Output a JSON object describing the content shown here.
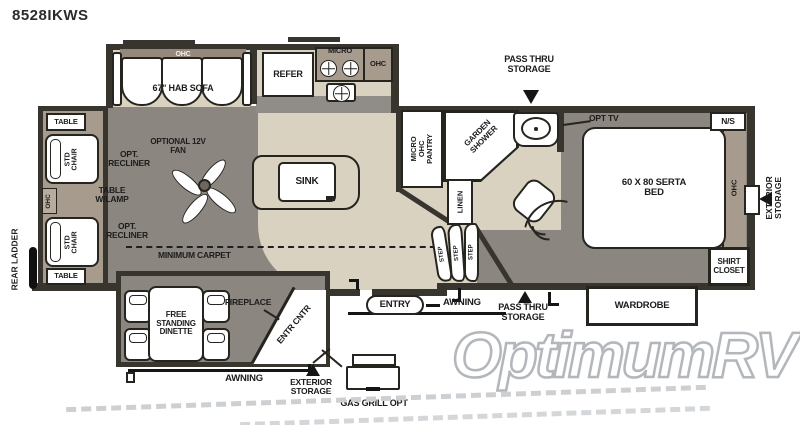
{
  "title": "8528IKWS",
  "watermark": "OptimumRV",
  "colors": {
    "wall": "#38352f",
    "carpet_gray": "#8c8681",
    "floor_beige": "#d9d2c0",
    "slide_taupe": "#a79b8d",
    "counter_gray": "#908d88",
    "watermark_stroke": "#b3b7bb"
  },
  "living": {
    "sofa_ohc": "OHC",
    "sofa": "67\" HAB SOFA",
    "table": "TABLE",
    "std_chair": "STD CHAIR",
    "opt_recliner": "OPT. RECLINER",
    "ohc": "OHC",
    "table_lamp": "TABLE W/LAMP",
    "rear_ladder": "REAR LADDER",
    "fan": "OPTIONAL 12V FAN",
    "min_carpet": "MINIMUM CARPET"
  },
  "kitchen": {
    "refer": "REFER",
    "micro": "MICRO",
    "ohc": "OHC",
    "sink": "SINK"
  },
  "dinette": {
    "table": "FREE STANDING DINETTE",
    "fireplace": "FIREPLACE",
    "entr_cntr": "ENTR CNTR"
  },
  "bath": {
    "pantry": "MICRO OHC PANTRY",
    "shower": "GARDEN SHOWER",
    "linen": "LINEN",
    "step": "STEP"
  },
  "bedroom": {
    "opt_tv": "OPT TV",
    "ns": "N/S",
    "bed": "60 X 80 SERTA BED",
    "ohc": "OHC",
    "shirt_closet": "SHIRT CLOSET",
    "wardrobe": "WARDROBE"
  },
  "exterior": {
    "pass_thru": "PASS THRU STORAGE",
    "awning": "AWNING",
    "entry": "ENTRY",
    "exterior_storage": "EXTERIOR STORAGE",
    "gas_grill": "GAS GRILL OPT"
  }
}
